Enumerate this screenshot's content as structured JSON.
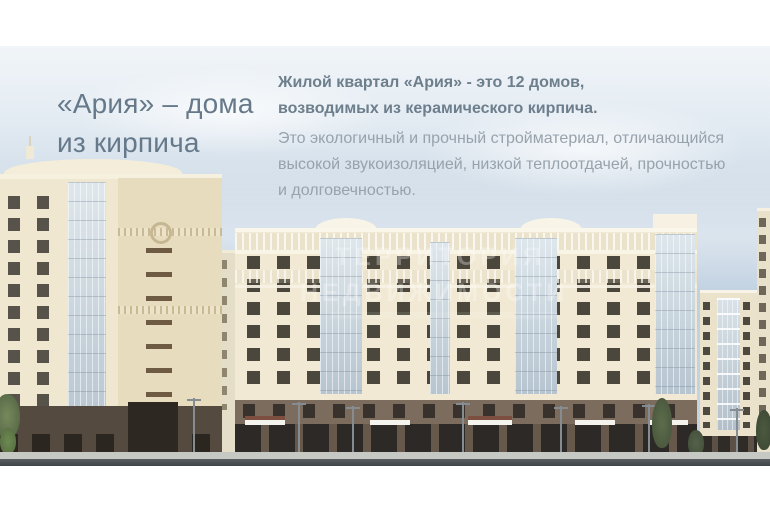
{
  "header": {
    "title_line1": "«Ария» – дома",
    "title_line2": "из кирпича"
  },
  "lead": {
    "line1": "Жилой квартал «Ария» - это 12 домов,",
    "line2": "возводимых из керамического кирпича."
  },
  "body": {
    "line1": "Это экологичный и прочный стройматериал, отличающийся",
    "line2": "высокой звукоизоляцией, низкой теплоотдачей, прочностью",
    "line3": "и долговечностью."
  },
  "watermark": {
    "line1": "ТЕРРИТОРИЯ",
    "line2": "НЕДВИЖИМОСТИ"
  },
  "colors": {
    "title_text": "#66798a",
    "lead_text": "#6d7e8c",
    "body_text": "#97a2ac",
    "sky_top": "#f1f5f8",
    "sky_bottom": "#c7d5e1",
    "facade_cream": "#f1e9d3",
    "facade_dark_cream": "#e7dcbd",
    "ground_brown": "#7b6c5d",
    "storefront_dark": "#4a423a",
    "road_gray": "#45494b"
  }
}
